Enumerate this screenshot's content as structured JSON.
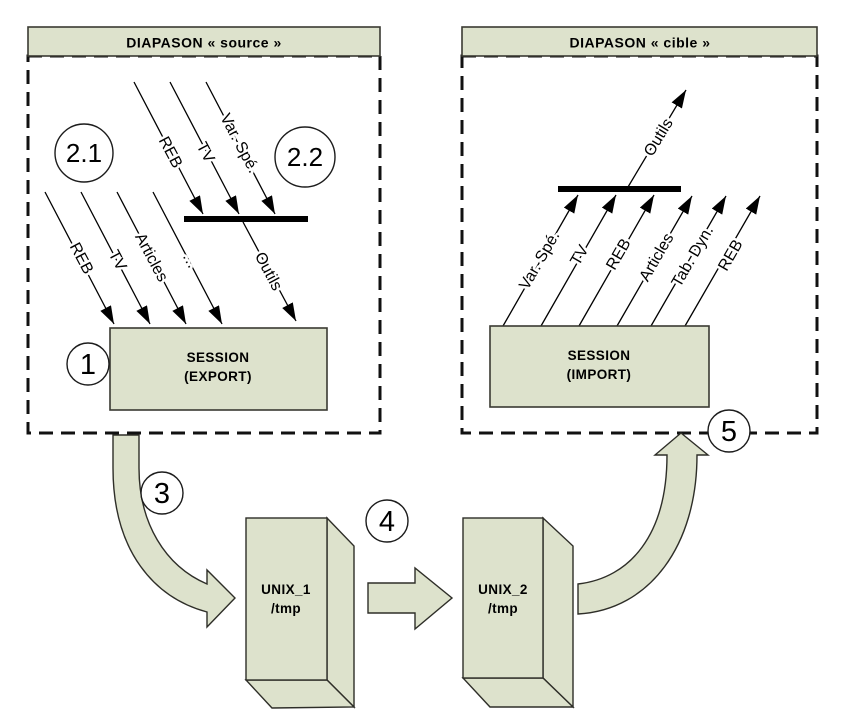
{
  "left_panel": {
    "title": "DIAPASON « source »",
    "upper_arrows": [
      "REB",
      "TV",
      "Var. Spé."
    ],
    "bar_arrow_label": "Outils",
    "lower_arrows": [
      "REB",
      "TV",
      "Articles",
      "…"
    ],
    "session": {
      "line1": "SESSION",
      "line2": "(EXPORT)"
    },
    "badge_1": "1",
    "badge_2_1": "2.1",
    "badge_2_2": "2.2"
  },
  "right_panel": {
    "title": "DIAPASON « cible »",
    "arrows": [
      "Var. Spé.",
      "TV",
      "REB",
      "Articles",
      "Tab. Dyn.",
      "REB"
    ],
    "bar_arrow_label": "Outils",
    "session": {
      "line1": "SESSION",
      "line2": "(IMPORT)"
    },
    "badge_5": "5"
  },
  "transfer": {
    "badge_3": "3",
    "badge_4": "4",
    "unix1": {
      "name": "UNIX_1",
      "path": "/tmp"
    },
    "unix2": {
      "name": "UNIX_2",
      "path": "/tmp"
    }
  },
  "colors": {
    "shape_fill": "#dde2cc",
    "shape_border": "#3a3a32",
    "arrow_color": "#000000",
    "background": "#ffffff"
  }
}
